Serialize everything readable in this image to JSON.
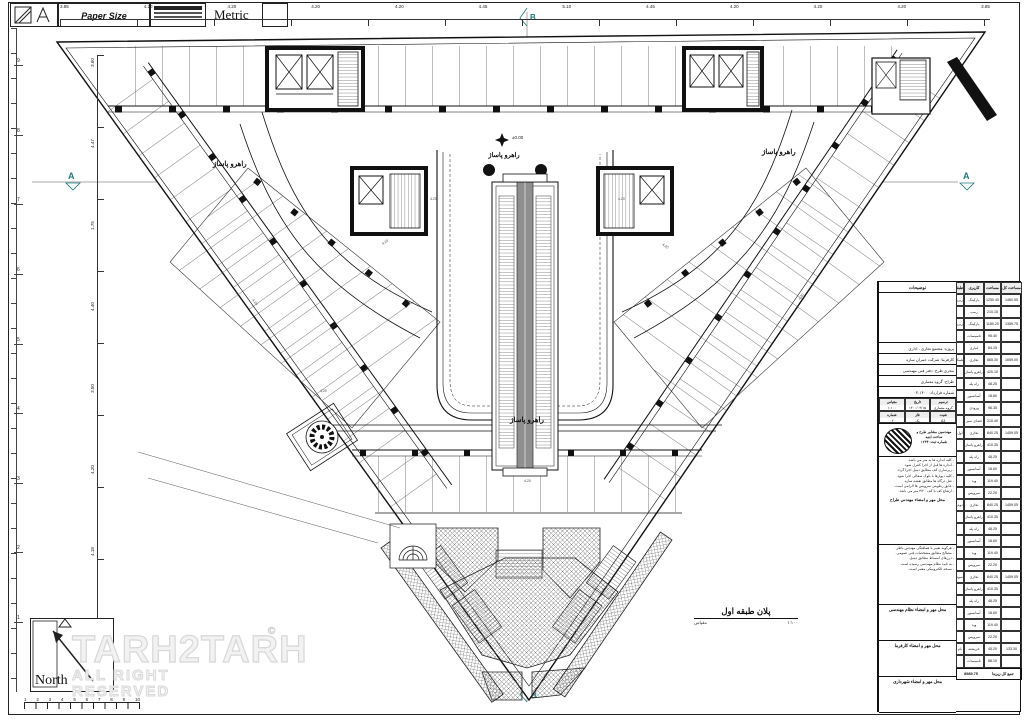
{
  "sheet": {
    "format": "A3",
    "paper_size_label": "Paper Size",
    "units_label": "Units",
    "metric_label": "Metric",
    "north_label": "North",
    "watermark": "TARH2TARH",
    "watermark_mark": "©",
    "watermark_sub": "ALL RIGHT RESERVED"
  },
  "plan": {
    "corridor_label": "راهرو پاساژ",
    "level_mark": "±0.00",
    "title": "پلان طبقه اول",
    "scale_label": "مقیاس",
    "scale_value": "۱:۱۰۰",
    "section_a": "A",
    "grid_b": "B"
  },
  "dims": {
    "inline": "4.20",
    "top": [
      "3.85",
      "4.20",
      "4.20",
      "4.20",
      "4.20",
      "4.45",
      "5.10",
      "4.45",
      "4.20",
      "4.20",
      "4.20",
      "3.85"
    ],
    "left": [
      "3.60",
      "4.47",
      "1.75",
      "4.40",
      "3.50",
      "4.20",
      "4.18",
      "3.60"
    ],
    "grid_rows": [
      "9",
      "8",
      "7",
      "6",
      "5",
      "4",
      "3",
      "2",
      "1"
    ],
    "scalebar": [
      "1",
      "2",
      "3",
      "4",
      "5",
      "6",
      "7",
      "8",
      "9",
      "10"
    ]
  },
  "titleblock": {
    "notes_title": "توضیحات",
    "header": {
      "total": "مساحت کل",
      "area": "مساحت",
      "usage": "کاربری",
      "floor": "طبقه"
    },
    "rows": [
      {
        "t": "1460.55",
        "a": "1250.40",
        "u": "پارکینگ",
        "f": "زیرزمین ۲"
      },
      {
        "t": "",
        "a": "210.15",
        "u": "رمپ",
        "f": ""
      },
      {
        "t": "1359.75",
        "a": "1180.20",
        "u": "پارکینگ",
        "f": "زیرزمین ۱"
      },
      {
        "t": "",
        "a": "95.40",
        "u": "تاسیسات",
        "f": ""
      },
      {
        "t": "",
        "a": "84.15",
        "u": "انباری",
        "f": ""
      },
      {
        "t": "1659.00",
        "a": "865.30",
        "u": "تجاری",
        "f": "همکف"
      },
      {
        "t": "",
        "a": "420.10",
        "u": "راهرو پاساژ",
        "f": ""
      },
      {
        "t": "",
        "a": "48.25",
        "u": "راه پله",
        "f": ""
      },
      {
        "t": "",
        "a": "18.60",
        "u": "آسانسور",
        "f": ""
      },
      {
        "t": "",
        "a": "96.35",
        "u": "ورودی",
        "f": ""
      },
      {
        "t": "",
        "a": "210.40",
        "u": "فضای سبز",
        "f": ""
      },
      {
        "t": "1459.05",
        "a": "840.25",
        "u": "تجاری",
        "f": "اول"
      },
      {
        "t": "",
        "a": "410.35",
        "u": "راهرو پاساژ",
        "f": ""
      },
      {
        "t": "",
        "a": "48.25",
        "u": "راه پله",
        "f": ""
      },
      {
        "t": "",
        "a": "18.60",
        "u": "آسانسور",
        "f": ""
      },
      {
        "t": "",
        "a": "119.40",
        "u": "وید",
        "f": ""
      },
      {
        "t": "",
        "a": "22.20",
        "u": "سرویس",
        "f": ""
      },
      {
        "t": "1459.05",
        "a": "840.25",
        "u": "تجاری",
        "f": "دوم"
      },
      {
        "t": "",
        "a": "410.35",
        "u": "راهرو پاساژ",
        "f": ""
      },
      {
        "t": "",
        "a": "48.25",
        "u": "راه پله",
        "f": ""
      },
      {
        "t": "",
        "a": "18.60",
        "u": "آسانسور",
        "f": ""
      },
      {
        "t": "",
        "a": "119.40",
        "u": "وید",
        "f": ""
      },
      {
        "t": "",
        "a": "22.20",
        "u": "سرویس",
        "f": ""
      },
      {
        "t": "1459.05",
        "a": "840.25",
        "u": "تجاری",
        "f": "سوم"
      },
      {
        "t": "",
        "a": "410.35",
        "u": "راهرو پاساژ",
        "f": ""
      },
      {
        "t": "",
        "a": "48.25",
        "u": "راه پله",
        "f": ""
      },
      {
        "t": "",
        "a": "18.60",
        "u": "آسانسور",
        "f": ""
      },
      {
        "t": "",
        "a": "119.40",
        "u": "وید",
        "f": ""
      },
      {
        "t": "",
        "a": "22.20",
        "u": "سرویس",
        "f": ""
      },
      {
        "t": "133.30",
        "a": "45.20",
        "u": "خرپشته",
        "f": "بام"
      },
      {
        "t": "",
        "a": "88.10",
        "u": "تاسیسات",
        "f": ""
      }
    ],
    "footer_label": "جمع کل زیربنا",
    "footer_value": "8989.75",
    "info": [
      "پروژه: مجتمع تجاری - اداری",
      "کارفرما: شرکت عمران سازه",
      "مجری طرح: دفتر فنی مهندسی",
      "طراح: گروه معماری",
      "شماره قرارداد: ۱۴۰۰-۰۴"
    ],
    "sign_cells": [
      {
        "label": "ترسیم",
        "value": "گروه معماری"
      },
      {
        "label": "تاریخ",
        "value": "۱۴۰۰/۰۴/۱۵"
      },
      {
        "label": "مقیاس",
        "value": "۱:۱۰۰"
      },
      {
        "label": "شیت",
        "value": "A3"
      },
      {
        "label": "فاز",
        "value": "یک"
      },
      {
        "label": "شماره",
        "value": "۰۲"
      }
    ],
    "stamp_line1": "مهندسین مشاور طرح و ساخت ابنیه",
    "stamp_line2": "شماره ثبت: ۱۲۳۴",
    "notes1": [
      "- کلیه اندازه ها به متر می باشد.",
      "- اندازه ها قبل از اجرا کنترل شود.",
      "- زیرسازی کف مطابق دیتیل اجرا گردد.",
      "- کلیه دیوارها با بلوک سفالی اجرا شود.",
      "- نعل درگاه ها مطابق نقشه سازه.",
      "- عایق رطوبتی سرویس ها الزامی است.",
      "- ارتفاع کف تا کف ۴/۲۰ متر می باشد."
    ],
    "notes1_sign": "محل مهر و امضاء مهندس طراح",
    "notes2": [
      "- هرگونه تغییر با هماهنگی مهندس ناظر.",
      "- مصالح مطابق مشخصات فنی عمومی.",
      "- درزهای انبساط مطابق دیتیل.",
      "- به تایید نظام مهندسی رسیده است.",
      "- نسخه الکترونیکی معتبر است."
    ],
    "seal_boxes": [
      "محل مهر و امضاء نظام مهندسی",
      "محل مهر و امضاء کارفرما",
      "محل مهر و امضاء شهرداری"
    ]
  }
}
